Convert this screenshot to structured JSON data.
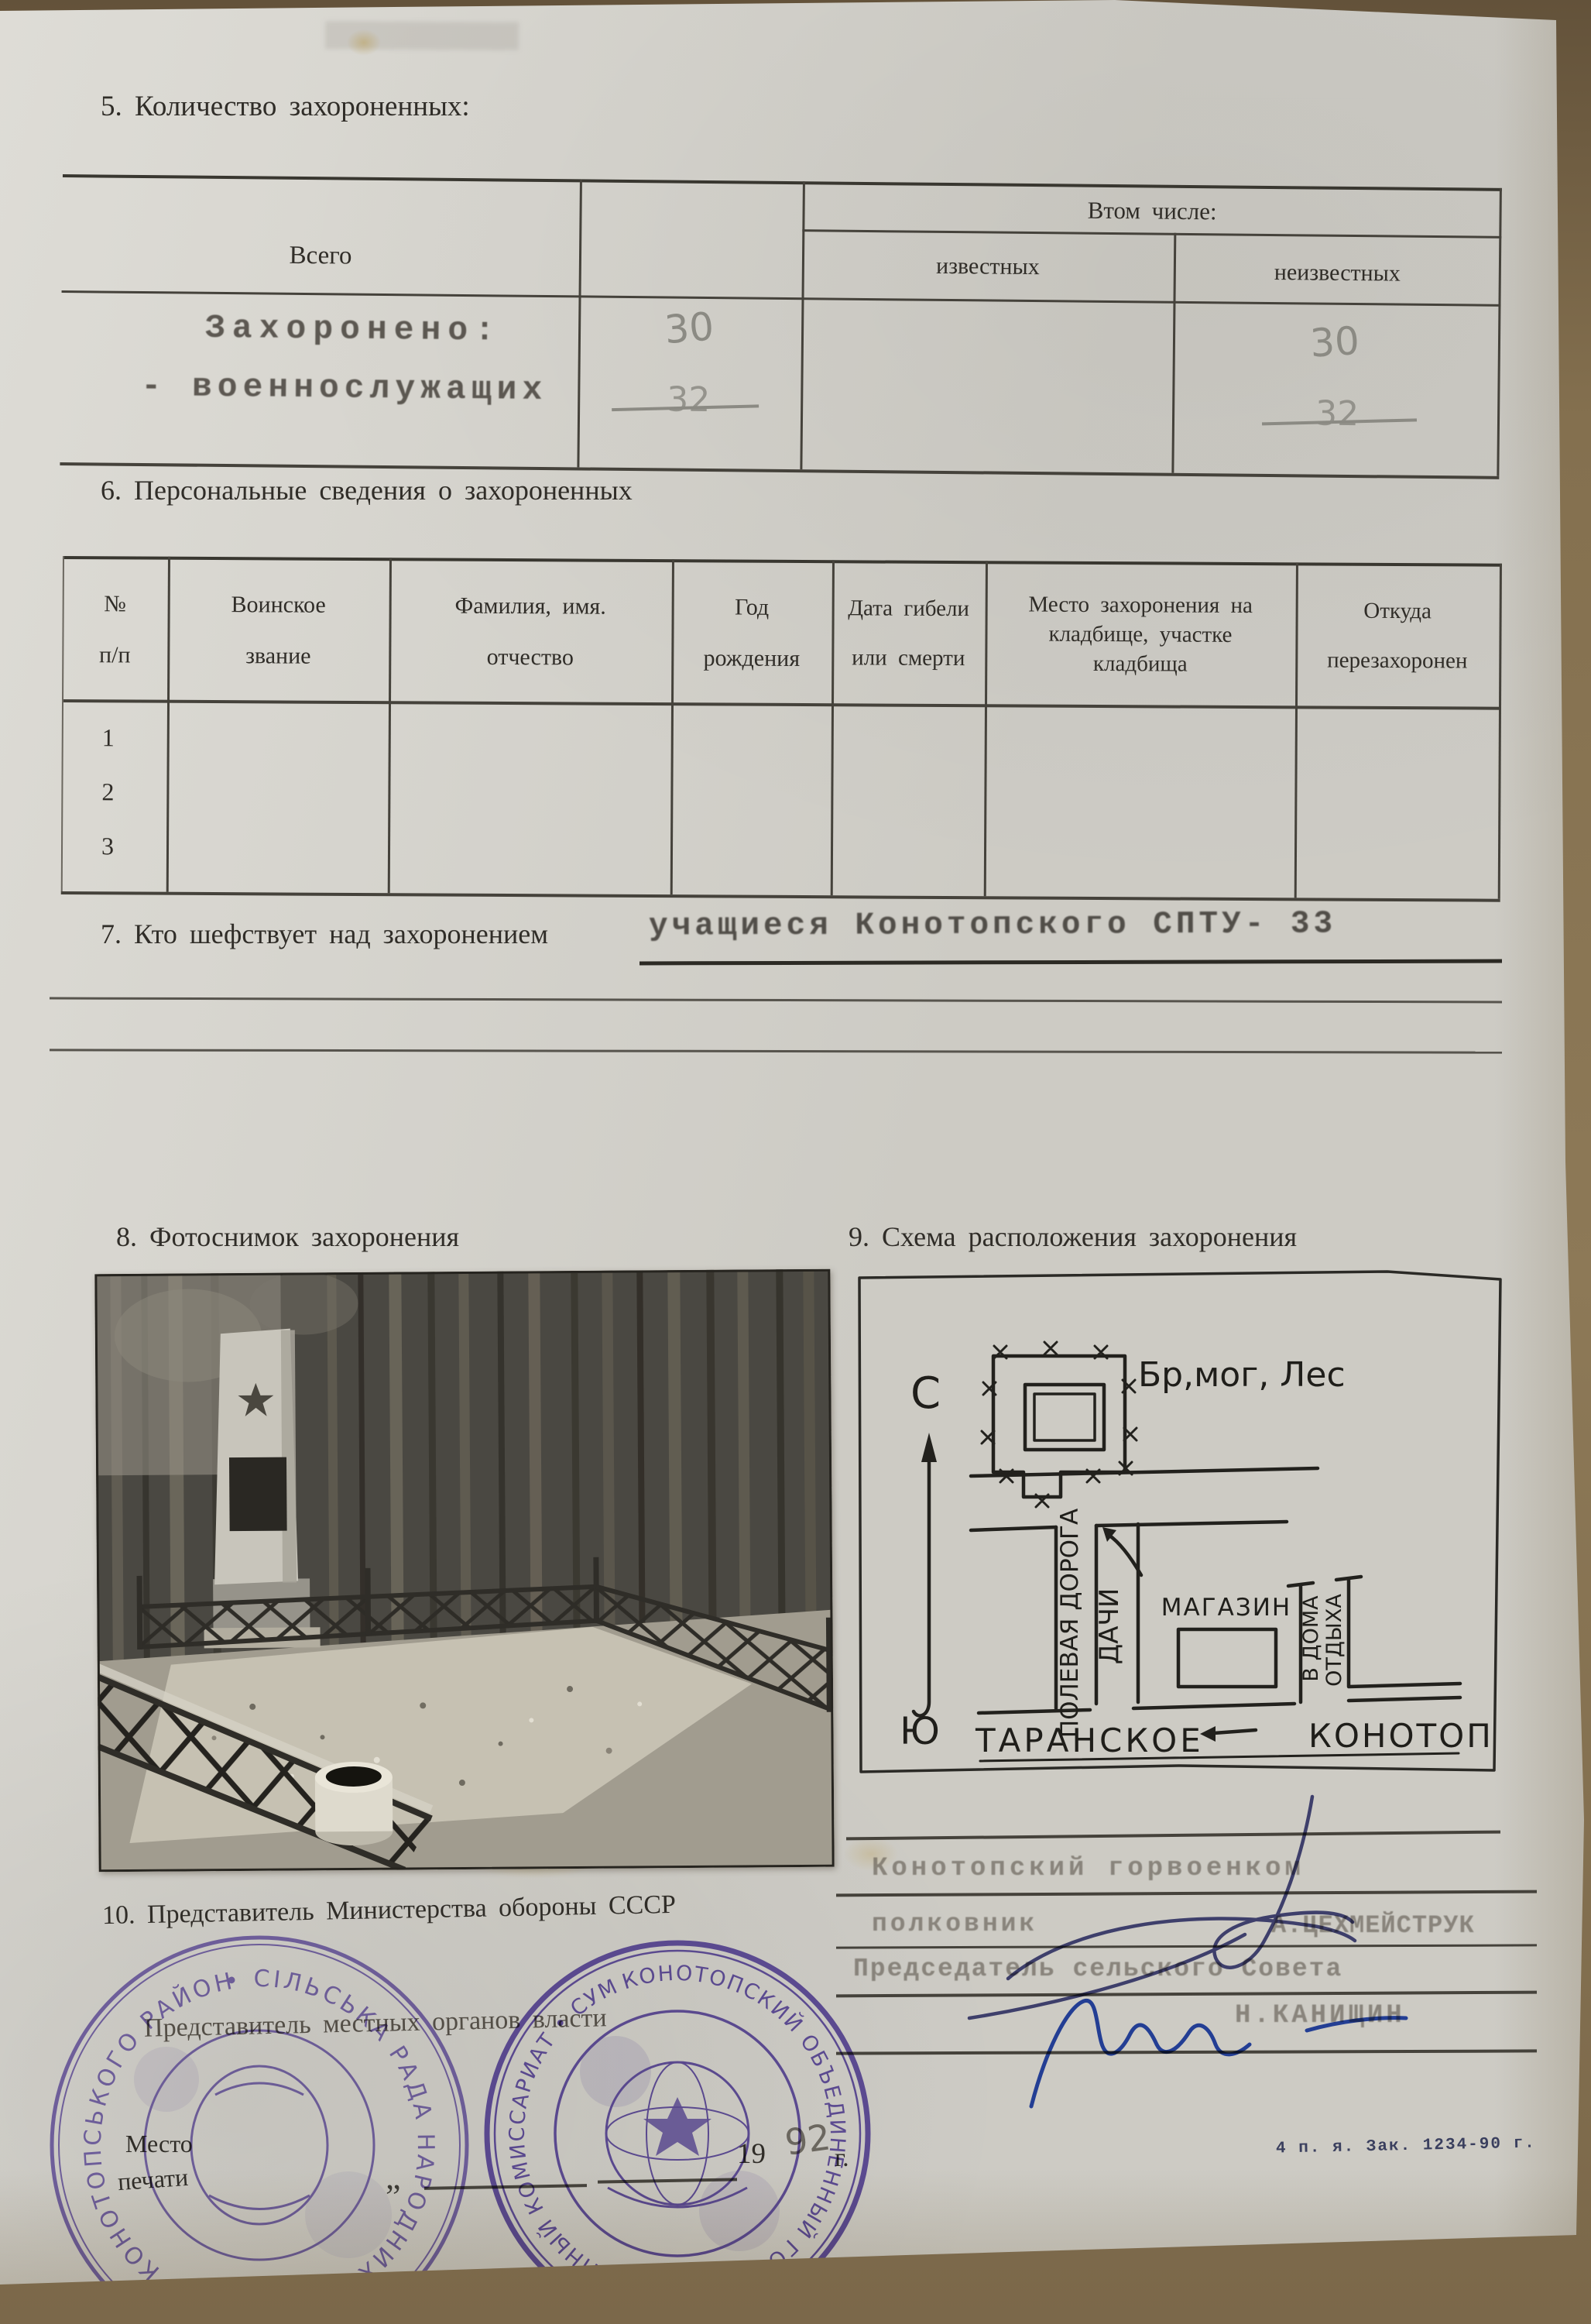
{
  "form": {
    "s5": {
      "title": "5. Количество захороненных:",
      "col_total": "Всего",
      "col_including": "Втом числе:",
      "col_known": "известных",
      "col_unknown": "неизвестных",
      "row_line1": "Захоронено:",
      "row_line2": "- военнослужащих",
      "total_value": "30",
      "total_crossed": "32",
      "unknown_value": "30",
      "unknown_crossed": "32"
    },
    "s6": {
      "title": "6. Персональные сведения о захороненных",
      "cols": [
        "№\nп/п",
        "Воинское\nзвание",
        "Фамилия, имя.\nотчество",
        "Год\nрождения",
        "Дата гибели\nили смерти",
        "Место захоронения на\nкладбище, участке\nкладбища",
        "Откуда\nперезахоронен"
      ],
      "rows": [
        "1",
        "2",
        "3"
      ]
    },
    "s7": {
      "label": "7. Кто шефствует над захоронением",
      "value": "учащиеся Конотопского СПТУ- 33"
    },
    "s8": {
      "title": "8. Фотоснимок захоронения"
    },
    "s9": {
      "title": "9. Схема расположения захоронения"
    },
    "map": {
      "grave_label": "Бр,мог, Лес",
      "north": "С",
      "south": "Ю",
      "field_road": "ПОЛЕВАЯ ДОРОГА",
      "dachas": "ДАЧИ",
      "shop": "МАГАЗИН",
      "rest_homes_1": "В ДОМА",
      "rest_homes_2": "ОТДЫХА",
      "town_left": "ТАРАНСКОЕ",
      "town_right": "КОНОТОП"
    },
    "s10": {
      "title": "10. Представитель Министерства обороны СССР",
      "local_label": "Представитель местных органов власти"
    },
    "sig": {
      "office": "Конотопский горвоенком",
      "rank": "полковник",
      "name1": "А.ЦЕХМЕЙСТРУК",
      "chair": "Председатель сельского Совета",
      "name2": "Н.КАНИЩИН"
    },
    "seal": {
      "line1": "Место",
      "line2": "печати"
    },
    "date": {
      "quote": "„",
      "prefix": "19",
      "year": "92",
      "suffix": "г."
    },
    "stamps": {
      "left_ring": "• СІЛЬСЬКА РАДА НАРОДНИХ ДЕПУТАТІВ • КОНОТОПСЬКОГО РАЙОНУ •",
      "right_ring": "КОНОТОПСКИЙ ОБЪЕДИНЕННЫЙ ГОРОДСКОЙ ВОЕННЫЙ КОМИССАРИАТ • СУМСКОЙ ОБЛАСТИ •"
    },
    "footer_note": "4 п. я. Зак. 1234-90 г."
  }
}
